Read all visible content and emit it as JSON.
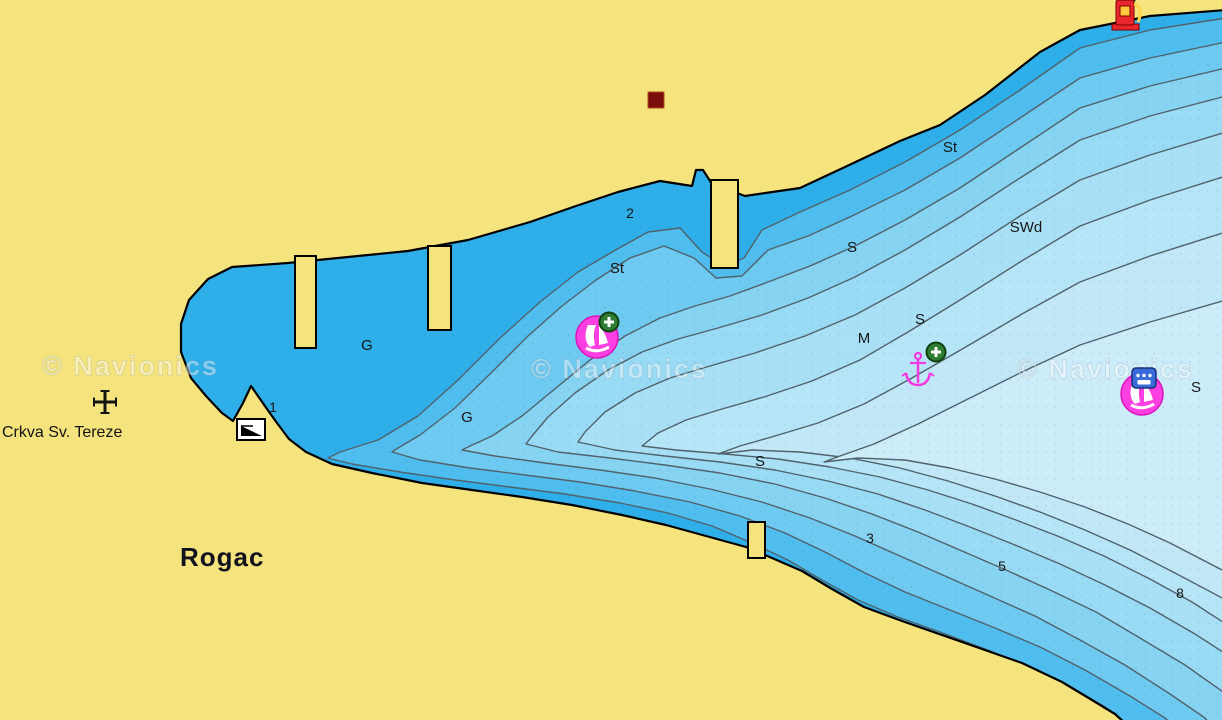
{
  "map": {
    "provider": "Navionics nautical chart",
    "watermarks": [
      {
        "text": "© Navionics"
      },
      {
        "text": "© Navionics"
      },
      {
        "text": "© Navionics"
      }
    ],
    "place_names": {
      "church_label": "Crkva Sv. Tereze",
      "town_label": "Rogac"
    },
    "depth_labels": [
      {
        "text": "2"
      },
      {
        "text": "1"
      },
      {
        "text": "3"
      },
      {
        "text": "5"
      },
      {
        "text": "8"
      }
    ],
    "seabed_labels": [
      {
        "text": "St"
      },
      {
        "text": "St"
      },
      {
        "text": "SWd"
      },
      {
        "text": "S"
      },
      {
        "text": "S"
      },
      {
        "text": "M"
      },
      {
        "text": "S"
      },
      {
        "text": "S"
      },
      {
        "text": "G"
      },
      {
        "text": "G"
      }
    ],
    "symbols": [
      {
        "name": "church-cross"
      },
      {
        "name": "boat-ramp"
      },
      {
        "name": "building-square"
      },
      {
        "name": "fuel-station"
      },
      {
        "name": "marina-west"
      },
      {
        "name": "marina-east"
      },
      {
        "name": "anchorage"
      },
      {
        "name": "poi-plus-west"
      },
      {
        "name": "poi-plus-anchorage"
      },
      {
        "name": "chat-badge"
      }
    ],
    "colors": {
      "land": "#F5E37D",
      "shoreline": "#000000",
      "contour_line": "#50626B",
      "water_bands": [
        "#2FAFEA",
        "#4FBEEE",
        "#6ECAF0",
        "#86D3F2",
        "#99DAF4",
        "#A9E0F6",
        "#B6E5F7",
        "#C2E8F8",
        "#CDECFA"
      ],
      "marina_magenta": "#FB3FE0",
      "anchor_magenta": "#F638E2",
      "poi_green": "#2F7D32",
      "badge_blue": "#3A6BD8",
      "fuel_red": "#E8262B",
      "building_dark_red": "#7A0C0C"
    }
  }
}
